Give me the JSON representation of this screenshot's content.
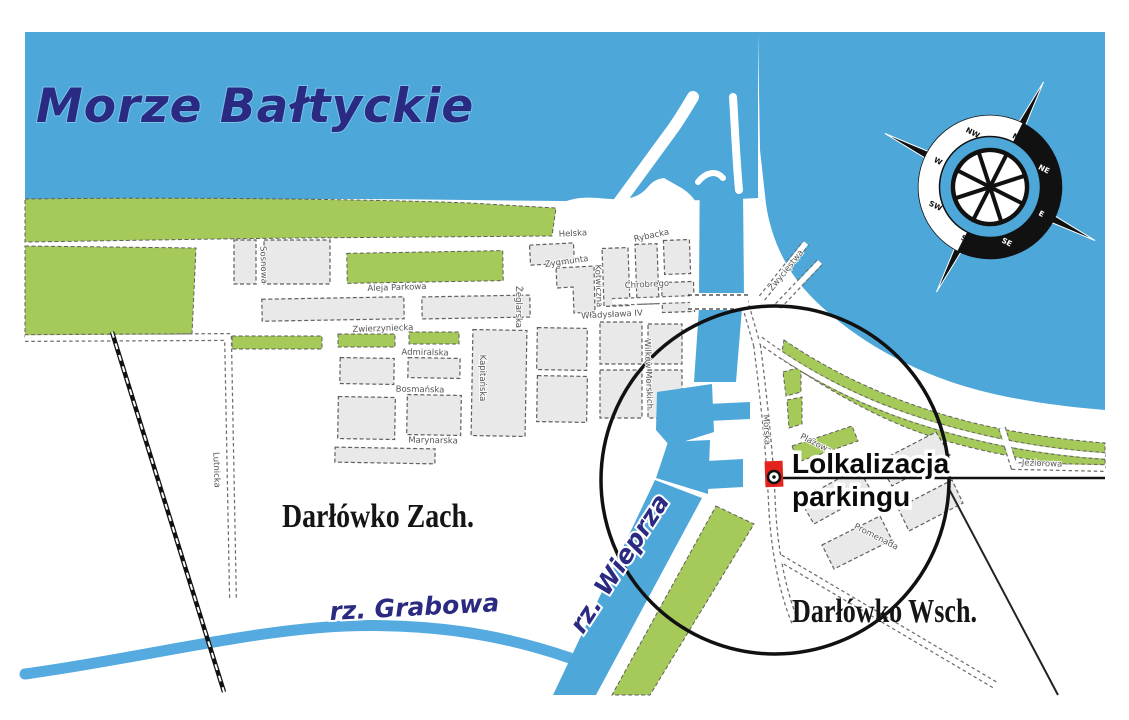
{
  "title": {
    "sea": "Morze Bałtyckie"
  },
  "districts": {
    "west": "Darłówko Zach.",
    "east": "Darłówko Wsch."
  },
  "rivers": {
    "grabowa": "rz. Grabowa",
    "wieprza": "rz. Wieprza"
  },
  "parking": {
    "line1": "Lolkalizacja",
    "line2": "parkingu"
  },
  "compass": {
    "directions": [
      "N",
      "NE",
      "E",
      "SE",
      "S",
      "SW",
      "W",
      "NW"
    ]
  },
  "streets": [
    {
      "name": "Aleja Parkowa"
    },
    {
      "name": "Zwierzyniecka"
    },
    {
      "name": "Admiralska"
    },
    {
      "name": "Bosmańska"
    },
    {
      "name": "Marynarska"
    },
    {
      "name": "Kapitańska"
    },
    {
      "name": "Żeglarska"
    },
    {
      "name": "Helska"
    },
    {
      "name": "Zygmunta"
    },
    {
      "name": "Chrobrego"
    },
    {
      "name": "Władysława IV"
    },
    {
      "name": "Rybacka"
    },
    {
      "name": "Wilków Morskich"
    },
    {
      "name": "Morska"
    },
    {
      "name": "Plażowa"
    },
    {
      "name": "Promenada"
    },
    {
      "name": "Jeziorowa"
    },
    {
      "name": "Zwycięstwa"
    },
    {
      "name": "Lutnicka"
    },
    {
      "name": "Sosnowa"
    },
    {
      "name": "Kotwiczna"
    }
  ],
  "colors": {
    "sea": "#4DA7D8",
    "land_green": "#A6CA5A",
    "river": "#55AADF",
    "navy_text": "#2B2A82",
    "marker_red": "#E3231C",
    "block_fill": "#E9E9E9",
    "line_black": "#111111"
  }
}
